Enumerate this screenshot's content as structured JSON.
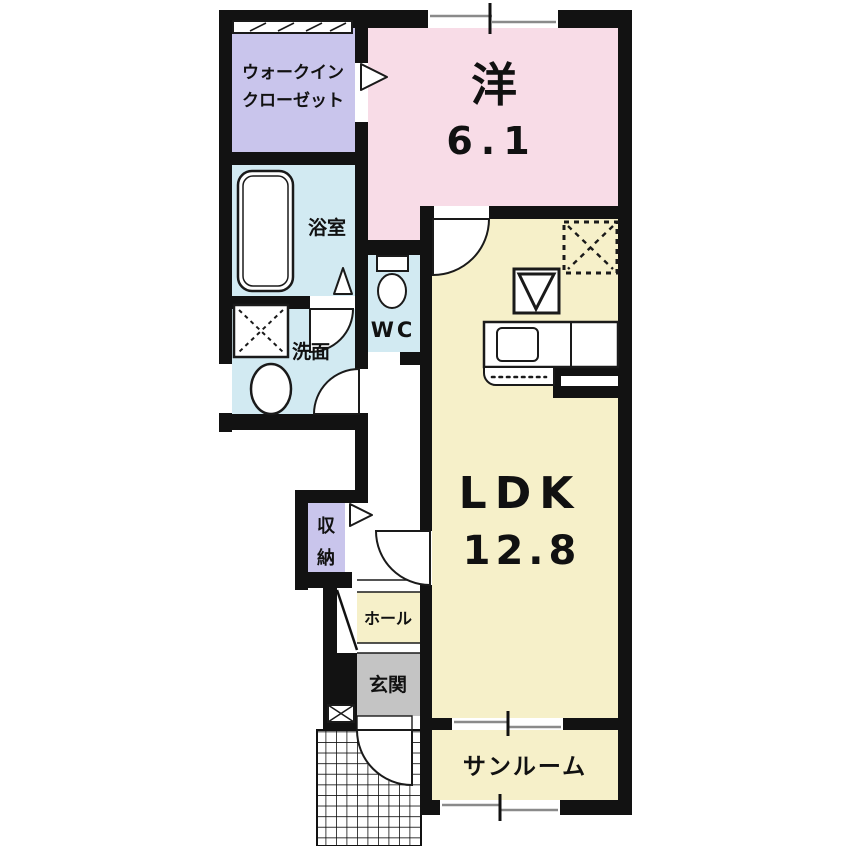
{
  "title": "apartment-floorplan",
  "rooms": {
    "wic": {
      "label_line1": "ウォークイン",
      "label_line2": "クローゼット",
      "color": "#c9c5ec"
    },
    "western": {
      "label": "洋",
      "size": "6.1",
      "color": "#f8dce7"
    },
    "bath": {
      "label": "浴室",
      "color": "#d2eaf2"
    },
    "washroom": {
      "label": "洗面",
      "color": "#d2eaf2"
    },
    "wc": {
      "label": "WC",
      "color": "#d2eaf2"
    },
    "ldk": {
      "label": "LDK",
      "size": "12.8",
      "color": "#f6f0c9"
    },
    "storage": {
      "label_char1": "収",
      "label_char2": "納",
      "color": "#c9c5ec"
    },
    "hall": {
      "label": "ホール",
      "color": "#f6f0c9"
    },
    "entrance": {
      "label": "玄関",
      "color": "#c4c4c4"
    },
    "sunroom": {
      "label": "サンルーム",
      "color": "#f6f0c9"
    }
  },
  "colors": {
    "wall": "#121212",
    "window_pane": "#8a8a8a",
    "background": "#ffffff"
  }
}
